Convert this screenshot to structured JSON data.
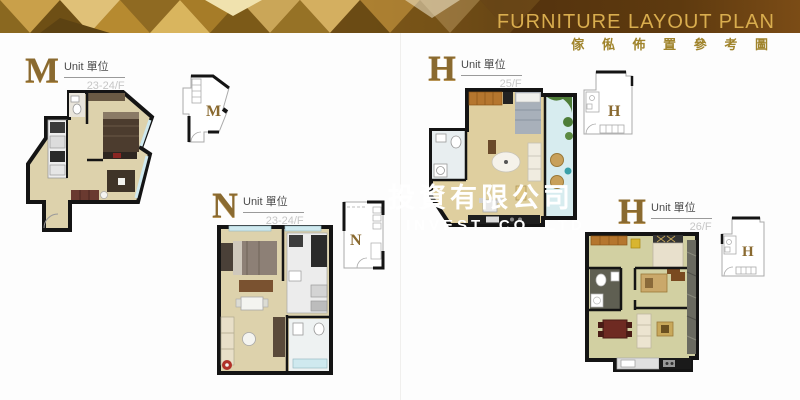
{
  "header": {
    "title": "FURNITURE LAYOUT PLAN",
    "subtitle": "傢 俬 佈 置 參 考 圖"
  },
  "watermark": {
    "line1": "投資有限公司",
    "line2": "INVEST. CO. LTD"
  },
  "units": [
    {
      "letter": "M",
      "unit_label": "Unit 單位",
      "floor": "23-24/F"
    },
    {
      "letter": "N",
      "unit_label": "Unit 單位",
      "floor": "23-24/F"
    },
    {
      "letter": "H",
      "unit_label": "Unit 單位",
      "floor": "25/F"
    },
    {
      "letter": "H",
      "unit_label": "Unit 單位",
      "floor": "26/F"
    }
  ],
  "colors": {
    "banner_title_gold": "#d9ad4e",
    "banner_subtitle_gold": "#a0842c",
    "banner_brown_dark": "#53320d",
    "unit_letter_brown": "#8a6a30",
    "floor_text_gray": "#c6c6c6",
    "wall_black": "#141414",
    "floor_beige": "#ddd2ac",
    "glass_blue": "#cfe9ef",
    "plant_green": "#4e7d38",
    "watermark_white": "#ffffff"
  }
}
